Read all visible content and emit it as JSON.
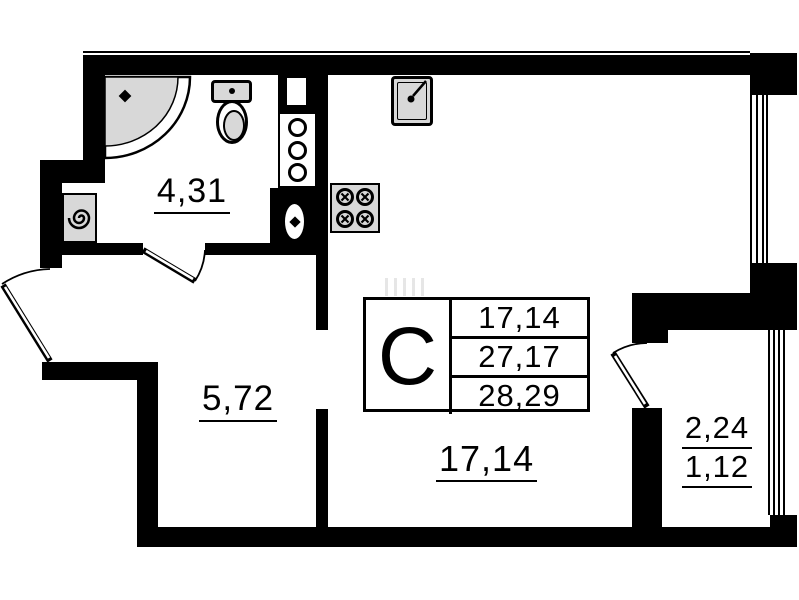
{
  "floorplan": {
    "legend": {
      "unit_type": "С",
      "areas": [
        "17,14",
        "27,17",
        "28,29"
      ]
    },
    "room_labels": {
      "bathroom": "4,31",
      "hallway": "5,72",
      "living_room": "17,14",
      "balcony": "2,24",
      "balcony_reduced": "1,12"
    },
    "colors": {
      "wall": "#000000",
      "fixture_fill": "#d8d8d8",
      "background": "#ffffff"
    }
  }
}
